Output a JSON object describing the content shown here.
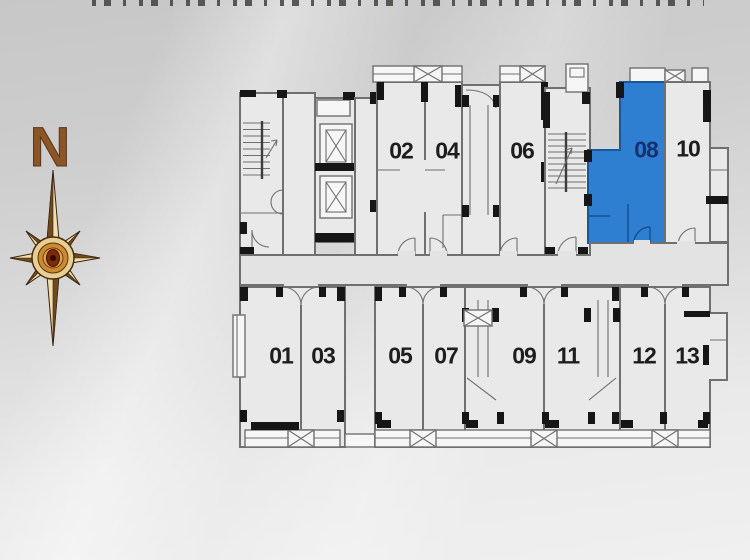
{
  "page": {
    "width": 750,
    "height": 560
  },
  "colors": {
    "highlight": "#2e7fd2",
    "highlight_border": "#1a5796",
    "highlight_label": "#17316d",
    "label": "#1d1d1d",
    "wall": "#707070",
    "accent": "#161616",
    "room_fill": "#e9e9e9",
    "corridor_fill": "#e3e3e3",
    "white_fill": "#f6f6f6",
    "compass_letter": "#8a5527",
    "bg_top": "#c7c7c7",
    "bg_bottom": "#f0f0f0"
  },
  "compass": {
    "label": "N"
  },
  "floor_plan": {
    "highlighted_unit": "08",
    "units": {
      "top": [
        {
          "label": "02"
        },
        {
          "label": "04"
        },
        {
          "label": "06"
        },
        {
          "label": "08"
        },
        {
          "label": "10"
        }
      ],
      "bottom": [
        {
          "label": "01"
        },
        {
          "label": "03"
        },
        {
          "label": "05"
        },
        {
          "label": "07"
        },
        {
          "label": "09"
        },
        {
          "label": "11"
        },
        {
          "label": "12"
        },
        {
          "label": "13"
        }
      ]
    },
    "icons": [
      "stairs-icon",
      "elevator-icon",
      "ac-platform-icon",
      "door-swing-icon",
      "compass-rose-icon"
    ]
  }
}
